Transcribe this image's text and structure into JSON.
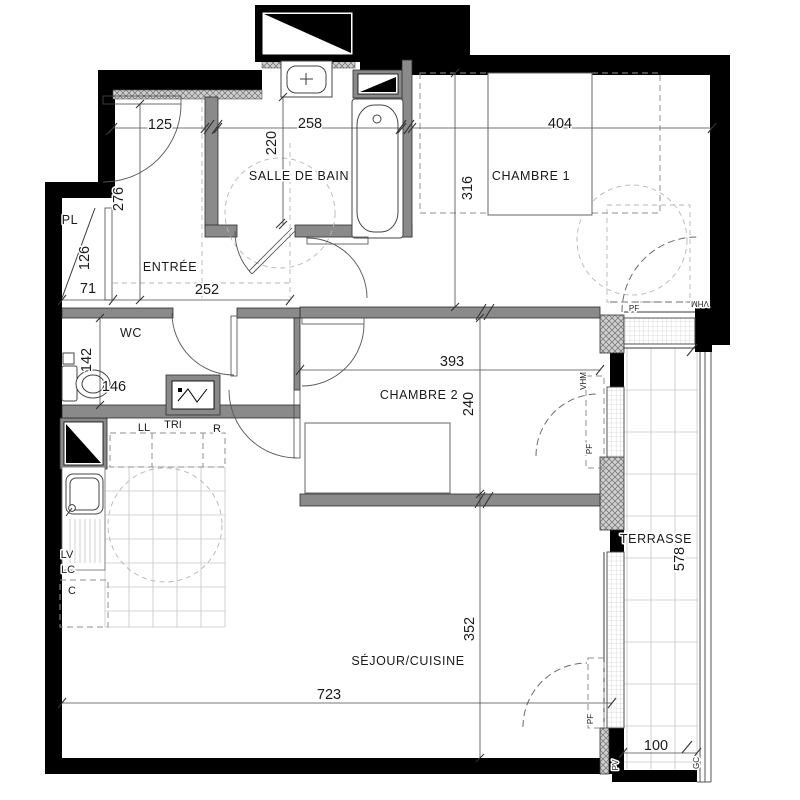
{
  "rooms": {
    "entree": "ENTRÉE",
    "salle_de_bain": "SALLE DE BAIN",
    "chambre1": "CHAMBRE 1",
    "chambre2": "CHAMBRE 2",
    "wc": "WC",
    "sejour": "SÉJOUR/CUISINE",
    "terrasse": "TERRASSE",
    "placard": "PL"
  },
  "dims": {
    "d125": "125",
    "d258": "258",
    "d404": "404",
    "d276": "276",
    "d126": "126",
    "d71": "71",
    "d252": "252",
    "d220": "220",
    "d316": "316",
    "d142": "142",
    "d146": "146",
    "d393": "393",
    "d240": "240",
    "d352": "352",
    "d723": "723",
    "d578": "578",
    "d100": "100"
  },
  "appliances": {
    "ll": "LL",
    "tri": "TRI",
    "r": "R",
    "lv": "LV",
    "lc": "LC",
    "c": "C"
  },
  "openings": {
    "pf_chambre1": "PF",
    "vhm_chambre1": "VHM",
    "pf_chambre2": "PF",
    "vhm_chambre2": "VHM",
    "pf_sejour": "PF",
    "pv": "PV",
    "gc": "GC"
  },
  "colors": {
    "wall": "#000000",
    "partition": "#8a8a8a",
    "hatch": "#c9c9c9",
    "dashed": "#8f8f8f",
    "tile": "#c7c7c7"
  }
}
